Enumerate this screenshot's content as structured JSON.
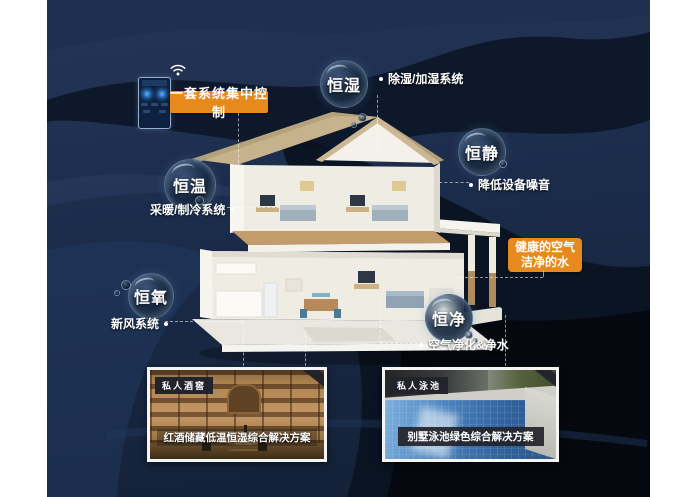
{
  "control": {
    "label": "一套系统集中控制",
    "device_icon": "smart-home-control-panel",
    "wifi_icon": "wifi"
  },
  "bubbles": [
    {
      "label": "恒湿",
      "desc": "除湿/加湿系统"
    },
    {
      "label": "恒静",
      "desc": "降低设备噪音"
    },
    {
      "label": "恒温",
      "desc": "采暖/制冷系统"
    },
    {
      "label": "恒氧",
      "desc": "新风系统"
    },
    {
      "label": "恒净",
      "desc": "空气净化&净水"
    }
  ],
  "highlight": {
    "line1": "健康的空气",
    "line2": "洁净的水"
  },
  "photos": [
    {
      "badge": "私人酒窖",
      "caption": "红酒储藏低温恒湿综合解决方案"
    },
    {
      "badge": "私人泳池",
      "caption": "别墅泳池绿色综合解决方案"
    }
  ],
  "colors": {
    "accent_orange": "#e8891e",
    "canvas_navy": "#1b2a47",
    "dark_wave": "#0a1220",
    "bubble_rim": "#9fc0dd",
    "badge_bg": "#23232b"
  },
  "illustration": {
    "subject": "two-story villa cutaway with smart home systems"
  }
}
